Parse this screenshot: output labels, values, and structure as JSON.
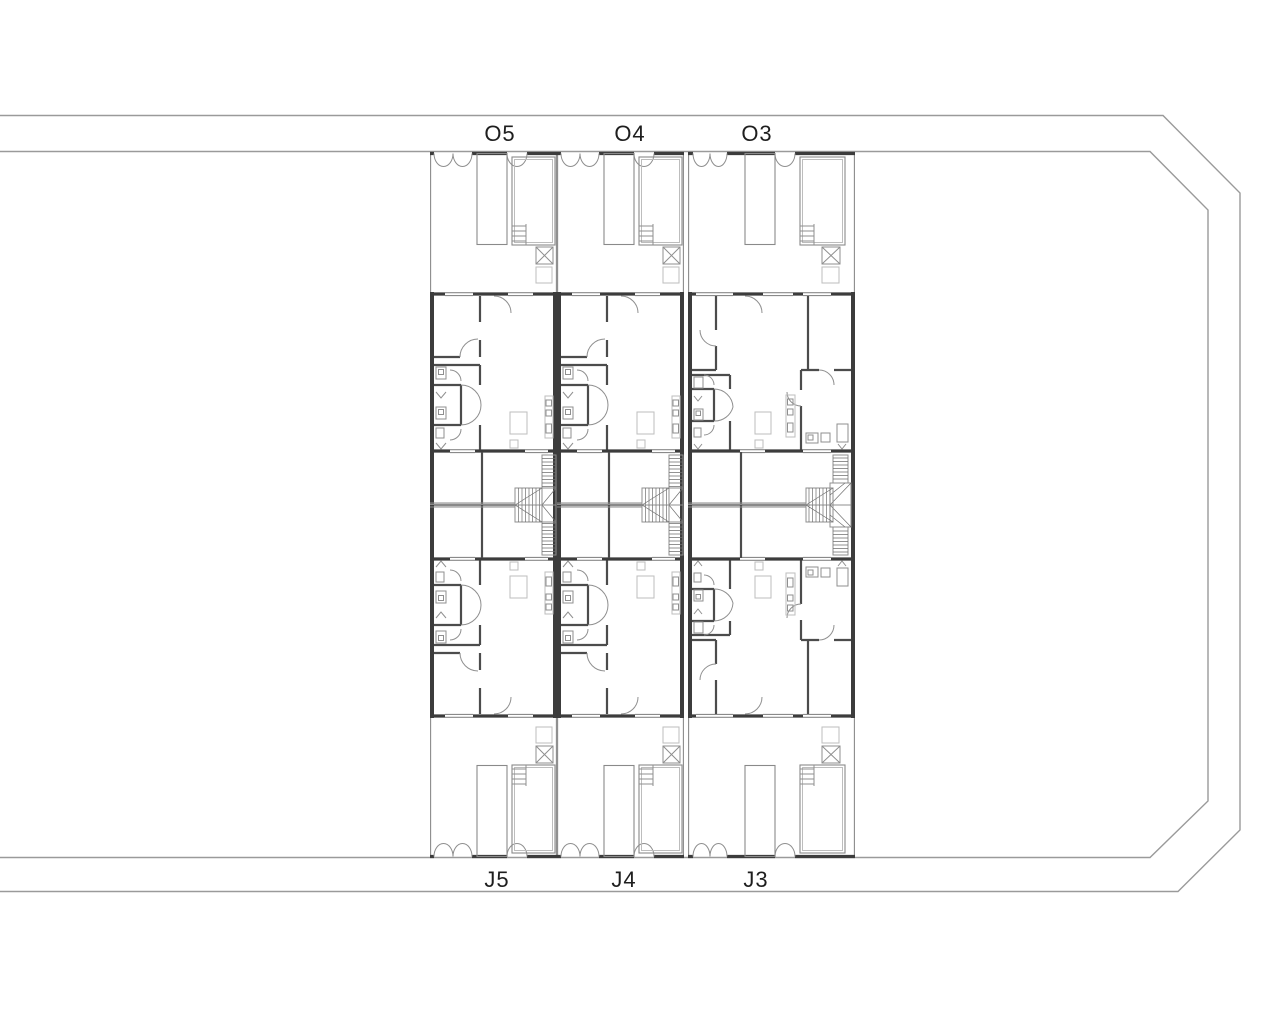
{
  "plan": {
    "type": "architectural-floor-plan",
    "description": "Site plan of three mirrored townhouse pairs between two streets",
    "units_top": [
      {
        "label": "O5"
      },
      {
        "label": "O4"
      },
      {
        "label": "O3"
      }
    ],
    "units_bottom": [
      {
        "label": "J5"
      },
      {
        "label": "J4"
      },
      {
        "label": "J3"
      }
    ],
    "colors": {
      "background": "#ffffff",
      "wall": "#3c3c3c",
      "partition": "#4c4c4c",
      "thin_line": "#8a8a8a",
      "site_boundary": "#9a9a9a",
      "furniture": "#bdbdbd",
      "fixture": "#8f8f8f",
      "label_text": "#1e1e1e"
    }
  }
}
